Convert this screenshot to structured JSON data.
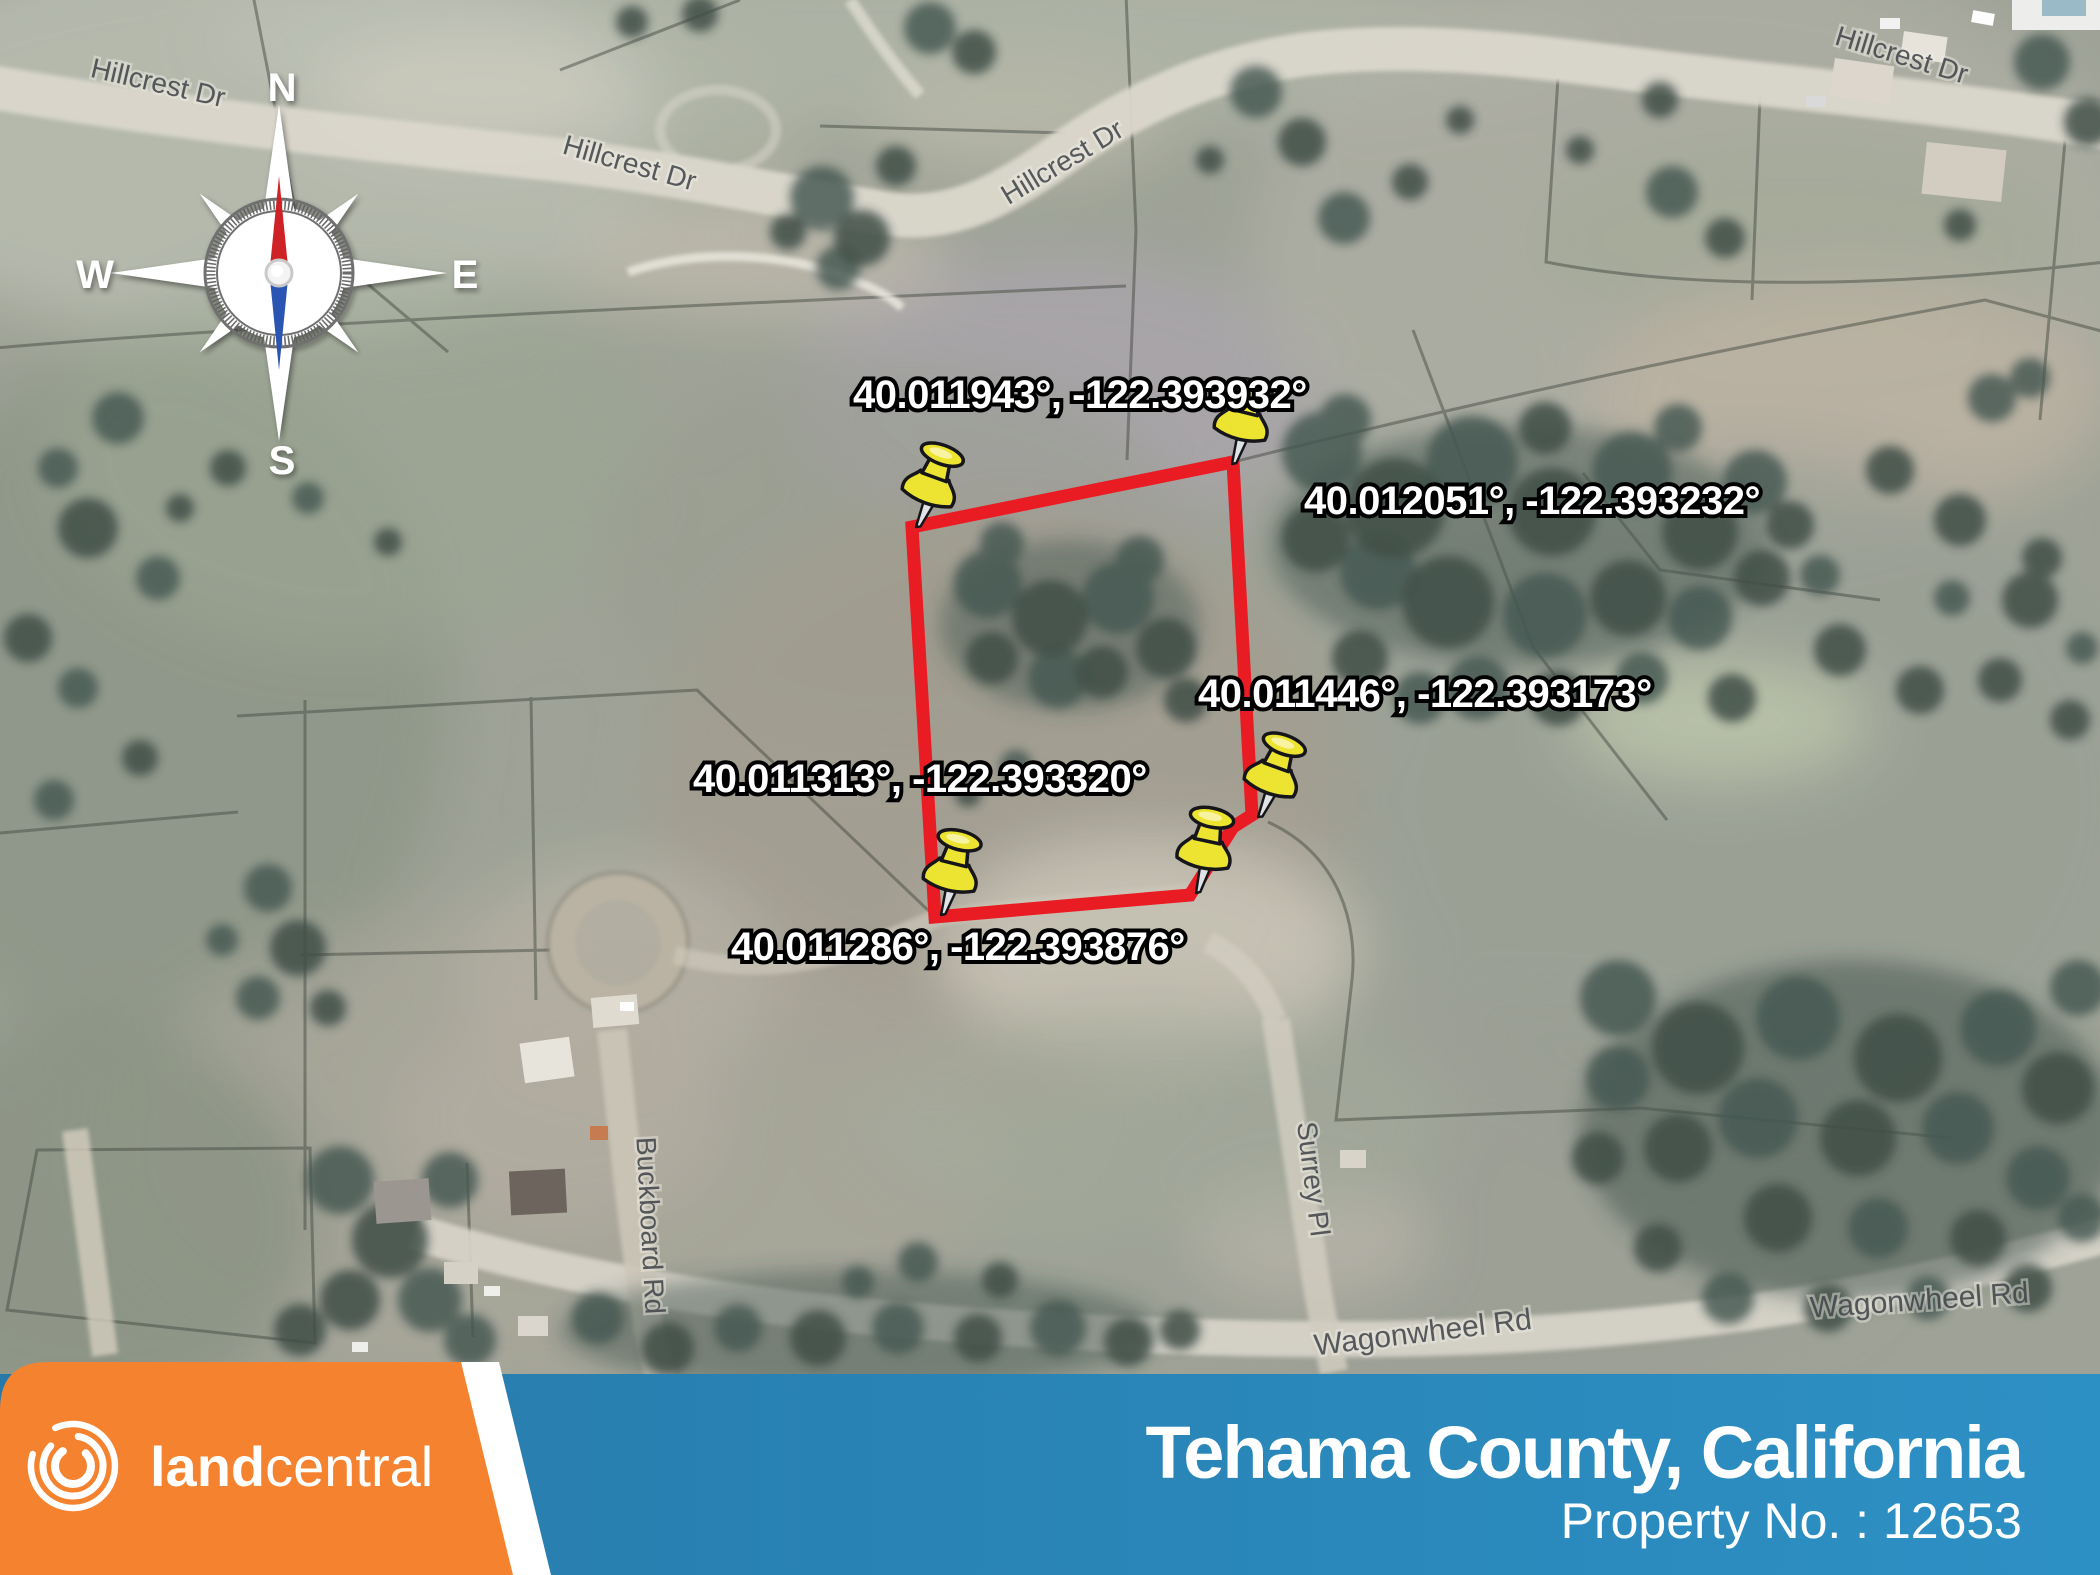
{
  "map": {
    "roads": {
      "hillcrest": "Hillcrest Dr",
      "wagonwheel": "Wagonwheel Rd",
      "buckboard": "Buckboard Rd",
      "surrey": "Surrey Pl"
    },
    "pins": [
      {
        "coords": "40.011943°, -122.393932°"
      },
      {
        "coords": "40.012051°, -122.393232°"
      },
      {
        "coords": "40.011446°, -122.393173°"
      },
      {
        "coords": "40.011313°, -122.393320°"
      },
      {
        "coords": "40.011286°, -122.393876°"
      }
    ]
  },
  "compass": {
    "north": "N",
    "south": "S",
    "east": "E",
    "west": "W"
  },
  "footer": {
    "brand_land": "land",
    "brand_central": "central",
    "county": "Tehama County, California",
    "property_no": "Property No. : 12653"
  },
  "colors": {
    "boundary_red": "#EA1C23",
    "pin_yellow": "#ECE431",
    "brand_orange": "#F5822F",
    "banner_blue_left": "#2679A9",
    "banner_blue_right": "#2D90C4"
  }
}
